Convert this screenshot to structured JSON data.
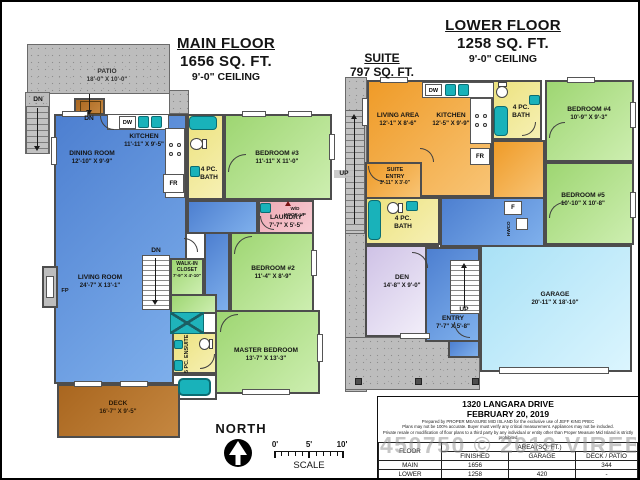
{
  "palette": {
    "wall": "#4d4d4d",
    "blue_room": "#5f93de",
    "green_room": "#aadc85",
    "yellow_bath": "#efe79a",
    "pink_laundry": "#f2b4bf",
    "orange_suite": "#f3a944",
    "lavender_den": "#d9cdea",
    "cyan_garage": "#bfe9f9",
    "deck_brown": "#b06f2a",
    "concrete_gray": "#bdbdbd",
    "fixture_teal": "#19b2ba"
  },
  "main_floor": {
    "title": "MAIN FLOOR",
    "area": "1656 SQ. FT.",
    "ceiling": "9'-0\" CEILING",
    "rooms": {
      "patio": {
        "name": "PATIO",
        "dims": "18'-0\" X 10'-0\""
      },
      "dining": {
        "name": "DINING ROOM",
        "dims": "12'-10\" X 9'-9\""
      },
      "kitchen": {
        "name": "KITCHEN",
        "dims": "11'-11\" X 9'-5\""
      },
      "bath": {
        "line1": "4 PC.",
        "line2": "BATH"
      },
      "bedroom3": {
        "name": "BEDROOM #3",
        "dims": "11'-11\" X 11'-0\""
      },
      "laundry": {
        "name": "LAUNDRY",
        "dims": "7'-7\" X 5'-5\""
      },
      "living": {
        "name": "LIVING ROOM",
        "dims": "24'-7\" X 13'-1\""
      },
      "wic": {
        "line1": "WALK-IN",
        "line2": "CLOSET",
        "dims": "7'-9\" X 4'-10\""
      },
      "bedroom2": {
        "name": "BEDROOM #2",
        "dims": "11'-4\" X 8'-9\""
      },
      "master": {
        "name": "MASTER BEDROOM",
        "dims": "13'-7\" X 13'-3\""
      },
      "ensuite": {
        "name": "5 PC. ENSUITE"
      },
      "deck": {
        "name": "DECK",
        "dims": "16'-7\" X 9'-5\""
      }
    },
    "labels": {
      "dn": "DN",
      "dw": "DW",
      "fr": "FR",
      "fp": "FP",
      "wd1": "W/D",
      "wd2": "HOOK-UP"
    }
  },
  "lower_floor": {
    "title": "LOWER FLOOR",
    "area": "1258 SQ. FT.",
    "ceiling": "9'-0\" CEILING",
    "suite": {
      "title": "SUITE",
      "area": "797 SQ. FT."
    },
    "rooms": {
      "living_area": {
        "name": "LIVING AREA",
        "dims": "12'-1\" X 8'-6\""
      },
      "kitchen": {
        "name": "KITCHEN",
        "dims": "12'-5\" X 9'-9\""
      },
      "bath_suite": {
        "line1": "4 PC.",
        "line2": "BATH"
      },
      "bedroom4": {
        "name": "BEDROOM #4",
        "dims": "10'-9\" X 9'-3\""
      },
      "suite_entry": {
        "line1": "SUITE",
        "line2": "ENTRY",
        "dims": "3'-11\" X 3'-0\""
      },
      "bath": {
        "line1": "4 PC.",
        "line2": "BATH"
      },
      "bedroom5": {
        "name": "BEDROOM #5",
        "dims": "10'-10\" X 10'-8\""
      },
      "den": {
        "name": "DEN",
        "dims": "14'-8\" X 9'-0\""
      },
      "entry": {
        "name": "ENTRY",
        "dims": "7'-7\" X 5'-8\""
      },
      "garage": {
        "name": "GARAGE",
        "dims": "20'-11\" X 18'-10\""
      }
    },
    "labels": {
      "up": "UP",
      "dw": "DW",
      "fr": "FR",
      "f": "F",
      "hw": "HWCO"
    }
  },
  "compass": {
    "label": "NORTH"
  },
  "scale_bar": {
    "t0": "0'",
    "t5": "5'",
    "t10": "10'",
    "label": "SCALE"
  },
  "info_table": {
    "address": "1320 LANGARA DRIVE",
    "date": "FEBRUARY 20, 2019",
    "disclaimer1": "Prepared by PROPER MEASURE MID ISLAND for the exclusive use of JEFF KING PREC",
    "disclaimer2": "Plans may not be 100% accurate.  Buyer must verify any critical measurement.  Appliances may not be included.",
    "disclaimer3": "Private resale  or modification of floor plans to a third party by any individual or entity other than Proper Measure Mid Island is strictly prohibited",
    "col_floor": "FLOOR",
    "col_area": "AREA (SQ. FT.)",
    "col_finished": "FINISHED",
    "col_garage": "GARAGE",
    "col_deck": "DECK / PATIO",
    "rows": {
      "main": {
        "floor": "MAIN",
        "finished": "1656",
        "garage": "",
        "deck": "344"
      },
      "lower": {
        "floor": "LOWER",
        "finished": "1258",
        "garage": "420",
        "deck": "-"
      },
      "total": {
        "floor": "TOTAL",
        "finished": "2914",
        "garage": "420",
        "deck": "344"
      }
    },
    "watermark": "450750 © 2019 VIREB"
  }
}
